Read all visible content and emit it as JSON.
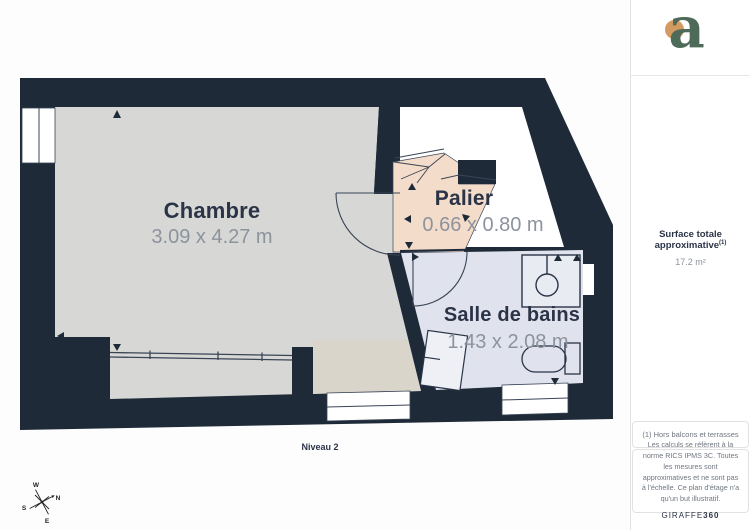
{
  "plan": {
    "level_label": "Niveau 2",
    "rooms": [
      {
        "name": "Chambre",
        "dims": "3.09 x 4.27 m"
      },
      {
        "name": "Palier",
        "dims": "0.66 x 0.80 m"
      },
      {
        "name": "Salle de bains",
        "dims": "1.43 x 2.08 m"
      }
    ],
    "compass": {
      "n": "N",
      "e": "E",
      "s": "S",
      "w": "W"
    }
  },
  "sidebar": {
    "logo_letter": "a",
    "surface_label": "Surface totale approximative",
    "surface_sup": "(1)",
    "surface_value": "17.2 m²",
    "note_1": "(1) Hors balcons et terrasses",
    "disclaimer": "Les calculs se réfèrent à la norme RICS IPMS 3C. Toutes les mesures sont approximatives et ne sont pas à l'échelle. Ce plan d'étage n'a qu'un but illustratif.",
    "brand_name": "GIRAFFE",
    "brand_suffix": "360"
  },
  "colors": {
    "wall": "#1e2a38",
    "room_chambre": "#d7d8d6",
    "room_terrace_tint": "#d9d5cb",
    "room_palier": "#f4dcca",
    "room_bath": "#e0e3ed",
    "label_navy": "#2b3447",
    "dims_gray": "#8d939d",
    "logo_green": "#4d6b58",
    "logo_orange": "#d49a5f"
  }
}
